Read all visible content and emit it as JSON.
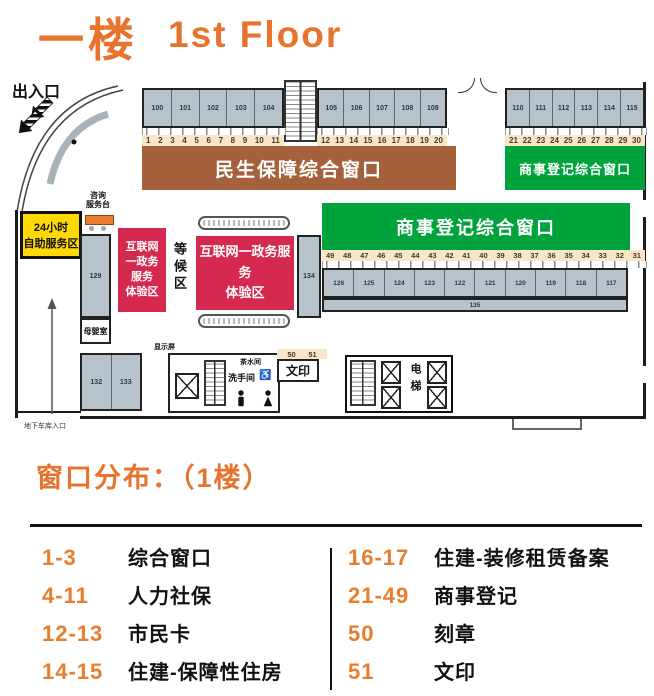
{
  "title": {
    "floor_cn": "一楼",
    "floor_en": "1st Floor"
  },
  "colors": {
    "accent_orange": "#E8732C",
    "banner_brown": "#A5613C",
    "banner_green": "#00A23C",
    "zone_red": "#D6294F",
    "self_service_yellow": "#FFD903",
    "room_gray": "#B7C3CB",
    "strip_beige": "#F7E7C7"
  },
  "plan": {
    "entrance_label": "出入口",
    "garage_entrance_label": "地下车库入口",
    "consult_desk_label": "咨询\n服务台",
    "self_service_label": "24小时\n自助服务区",
    "nursing_room_label": "母婴室",
    "waiting_area_label": "等候区",
    "internet_zone_small_label": "互联网\n一政务\n服务\n体验区",
    "internet_zone_large_label": "互联网一政务服务\n体验区",
    "display_screen_label": "显示屏",
    "tea_room_label": "茶水间",
    "restroom_label": "洗手间",
    "wheelchair_icon": "♿",
    "print_room_label": "文印",
    "elevator_label": "电梯",
    "banners": {
      "minsheng": "民生保障综合窗口",
      "commerce_top": "商事登记综合窗口",
      "commerce_mid": "商事登记综合窗口"
    },
    "rooms": {
      "top_left": [
        "100",
        "101",
        "102",
        "103",
        "104"
      ],
      "top_mid": [
        "105",
        "106",
        "107",
        "108",
        "109"
      ],
      "top_right": [
        "110",
        "111",
        "112",
        "113",
        "114",
        "115"
      ],
      "mid": [
        "126",
        "125",
        "124",
        "123",
        "122",
        "121",
        "120",
        "119",
        "118",
        "117"
      ],
      "bottom_left": [
        "132",
        "133"
      ],
      "r129": "129",
      "r134": "134",
      "r135": "135"
    },
    "windows": {
      "left": [
        "1",
        "2",
        "3",
        "4",
        "5",
        "6",
        "7",
        "8",
        "9",
        "10",
        "11"
      ],
      "mid": [
        "12",
        "13",
        "14",
        "15",
        "16",
        "17",
        "18",
        "19",
        "20"
      ],
      "right": [
        "21",
        "22",
        "23",
        "24",
        "25",
        "26",
        "27",
        "28",
        "29",
        "30"
      ],
      "center": [
        "49",
        "48",
        "47",
        "46",
        "45",
        "44",
        "43",
        "42",
        "41",
        "40",
        "39",
        "38",
        "37",
        "36",
        "35",
        "34",
        "33",
        "32",
        "31"
      ],
      "print": [
        "50",
        "51"
      ]
    }
  },
  "legend": {
    "title": "窗口分布：（1楼）",
    "left": [
      {
        "range": "1-3",
        "label": "综合窗口"
      },
      {
        "range": "4-11",
        "label": "人力社保"
      },
      {
        "range": "12-13",
        "label": "市民卡"
      },
      {
        "range": "14-15",
        "label": "住建-保障性住房"
      }
    ],
    "right": [
      {
        "range": "16-17",
        "label": "住建-装修租赁备案"
      },
      {
        "range": "21-49",
        "label": "商事登记"
      },
      {
        "range": "50",
        "label": "刻章"
      },
      {
        "range": "51",
        "label": "文印"
      }
    ]
  }
}
